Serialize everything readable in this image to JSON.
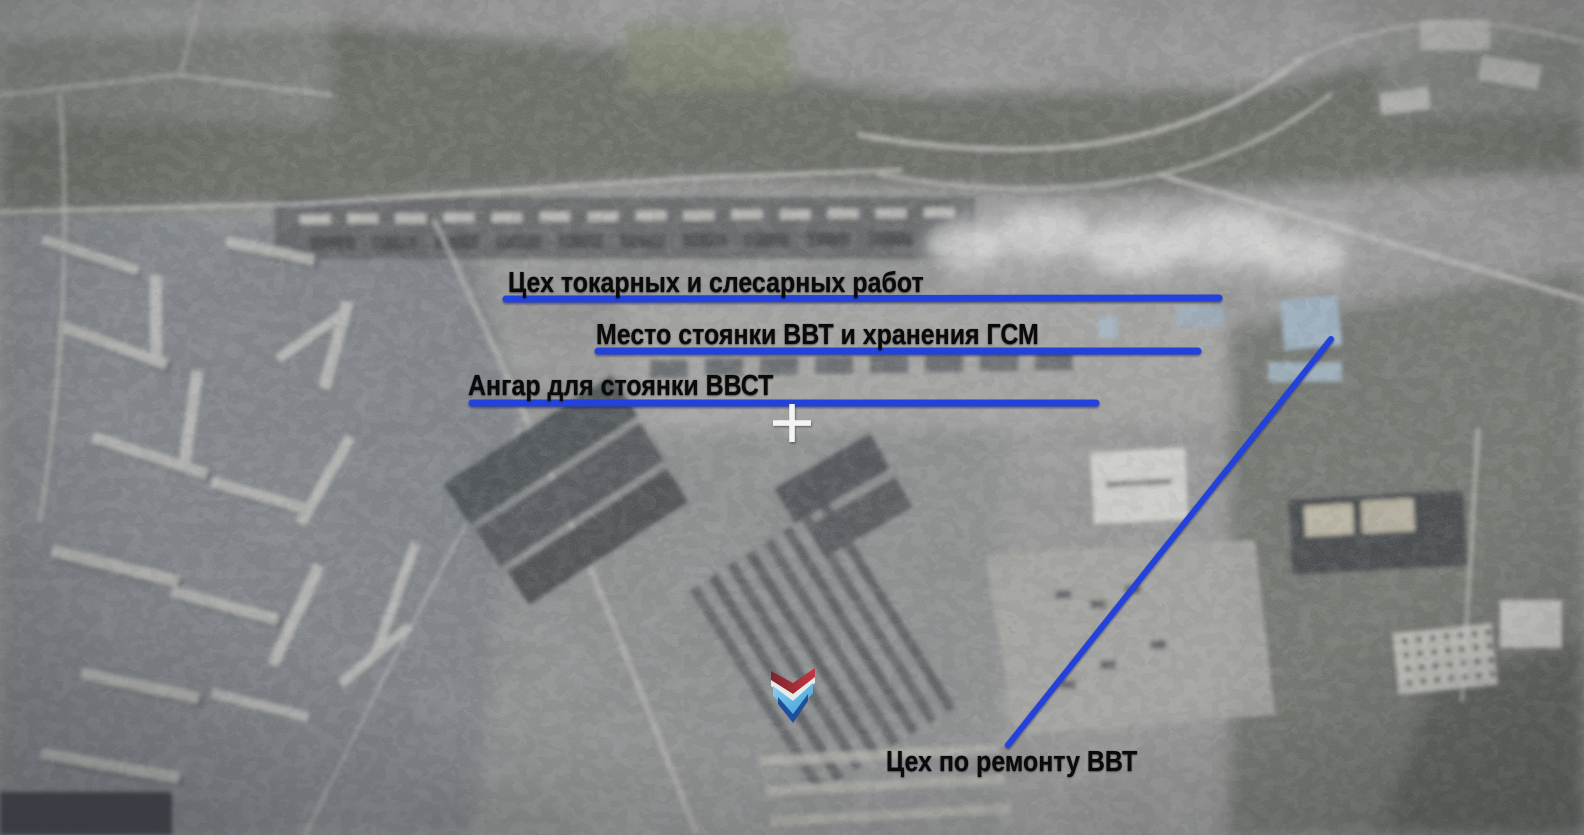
{
  "scene": {
    "description": "Aerial reconnaissance video frame of an industrial facility with Russian annotation labels",
    "colors": {
      "annotation_blue": "#2342db",
      "label_text": "#0a0a0a",
      "crosshair_white": "#f4f5f2"
    },
    "labels": [
      {
        "id": "lathe-and-metalwork-shop",
        "text": "Цех токарных и слесарных работ",
        "underlined": true
      },
      {
        "id": "vvt-parking-and-fuel-storage",
        "text": "Место стоянки ВВТ и хранения ГСМ",
        "underlined": true
      },
      {
        "id": "vvst-parking-hangar",
        "text": "Ангар для стоянки ВВСТ",
        "underlined": true
      },
      {
        "id": "vvt-repair-shop",
        "text": "Цех по ремонту ВВТ",
        "underlined": false
      }
    ],
    "icons": [
      {
        "name": "crosshair-icon",
        "glyph": "white plus reticle on imagery"
      },
      {
        "name": "chevron-emblem-icon",
        "glyph": "red over blue downward chevron watermark"
      }
    ]
  }
}
